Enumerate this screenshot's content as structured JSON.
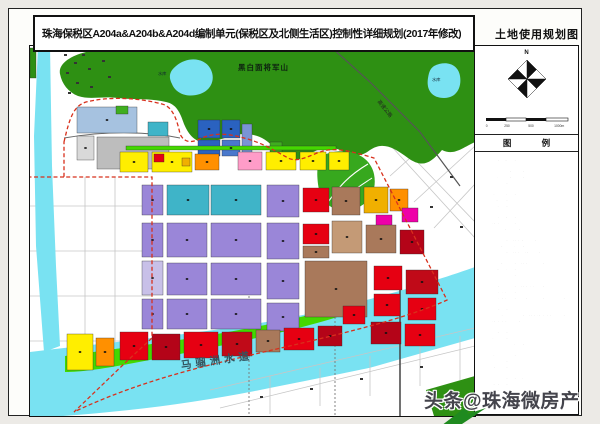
{
  "page_title": "珠海保税区A204a&A204b&A204d编制单元(保税区及北侧生活区)控制性详细规划(2017年修改)",
  "map_sheet_title": "土地使用规划图",
  "compass_label": "N",
  "scale_labels": [
    "0",
    "250",
    "500",
    "1000m"
  ],
  "legend_header": "图 例",
  "watermark": "头条@珠海微房产",
  "map_labels": {
    "mountain": "黑白面将军山",
    "reservoir_1": "水库",
    "reservoir_2": "水库",
    "expressway": "高速公路",
    "waterway": "马骝洲水道"
  },
  "colors": {
    "hill_green": "#2e9013",
    "park_green": "#37a81e",
    "water_cyan": "#79e2f2",
    "shore_green": "#44d800",
    "boundary_red": "#d8301c",
    "outside_road_gray": "#c6c6c6",
    "corner_green": "#1f8a1f"
  },
  "legend_items": [
    {
      "label": "二类居住用地",
      "color": "#ffee00"
    },
    {
      "label": "居住用地（兼容商业服务业设施用地）",
      "color": "#e0c000"
    },
    {
      "label": "一般商业中心用地",
      "color": "#ff5a28"
    },
    {
      "label": "二级商业中心用地",
      "color": "#c00a18"
    },
    {
      "label": "商业用地",
      "color": "#ff9000"
    },
    {
      "label": "行政办公用地",
      "color": "#ee00a8"
    },
    {
      "label": "文化设施用地",
      "color": "#ff9cc8"
    },
    {
      "label": "幼托用地",
      "color": "#ffb888"
    },
    {
      "label": "小学用地",
      "color": "#ff8428"
    },
    {
      "label": "中学用地",
      "color": "#ff3c14"
    },
    {
      "label": "医疗卫生用地",
      "color": "#ffc8d2"
    },
    {
      "label": "社会福利用地",
      "color": "#b05ad0"
    },
    {
      "label": "加油加气站用地",
      "color": "#ee0040"
    },
    {
      "label": "商业用地（兼容二类居住用地）",
      "color": "#c81428"
    },
    {
      "label": "商业用地（兼容办公用地）",
      "color": "#aa0a20"
    },
    {
      "label": "商业办公混合用地",
      "color": "#8e0414"
    },
    {
      "label": "商业用地（兼容旅馆业用地）",
      "color": "#b04a34"
    },
    {
      "label": "商务办公用地",
      "color": "#7c0a0a"
    },
    {
      "label": "商务办公用地（兼容商业用地）",
      "color": "#a85a48"
    },
    {
      "label": "商住混合用地",
      "color": "#960000"
    },
    {
      "label": "新型产业用地",
      "color": "#e8b49c"
    },
    {
      "label": "一类工业用地",
      "color": "#a06848"
    },
    {
      "label": "一类工业用地（兼容仓储用地）",
      "color": "#c49a76"
    },
    {
      "label": "物流仓储用地",
      "color": "#b2a2ba"
    },
    {
      "label": "混合功能用地（一类工业用地＋商业用地）",
      "color": "#e60028"
    },
    {
      "label": "弹性管理用地（一类工业用地＋新型产业用地＋仓储用地）",
      "color": "#b8a8e0"
    },
    {
      "label": "特殊用地",
      "color": "#8294b2"
    },
    {
      "label": "公共交通场站用地（兼容社会停车场用地）",
      "color": "#8a6cc8"
    },
    {
      "label": "社会停车场用地",
      "color": "#ccc2ea"
    },
    {
      "label": "供水用地",
      "color": "#2a5ac0"
    },
    {
      "label": "供电用地",
      "color": "#4a82d8"
    },
    {
      "label": "排水用地",
      "color": "#0a86a0"
    },
    {
      "label": "其他公用设施用地",
      "color": "#1aa89e"
    },
    {
      "label": "口岸设施用地",
      "color": "#32b6d0"
    },
    {
      "label": "交通枢纽用地",
      "color": "#8ecce8"
    },
    {
      "label": "公园绿地",
      "color": "#22a822"
    },
    {
      "label": "防护绿地",
      "color": "#7ed23e"
    },
    {
      "label": "广场用地",
      "color": "#2ec662"
    },
    {
      "label": "公园绿地（地下空间利用）",
      "color": "#a8e078"
    },
    {
      "label": "生态绿地",
      "color": "#d2eeb0"
    },
    {
      "label": "湿地",
      "color": "#aef0e6"
    },
    {
      "label": "水域",
      "color": "#9ae8f8"
    },
    {
      "label": "道路用地",
      "color": "#ffffff"
    }
  ],
  "parcels": [
    {
      "x": 47,
      "y": 61,
      "w": 60,
      "h": 26,
      "c": "#a6c2e0"
    },
    {
      "x": 67,
      "y": 91,
      "w": 72,
      "h": 32,
      "c": "#bdbdbd"
    },
    {
      "x": 47,
      "y": 90,
      "w": 17,
      "h": 24,
      "c": "#d9d9d9"
    },
    {
      "x": 168,
      "y": 74,
      "w": 22,
      "h": 18,
      "c": "#2a62c0"
    },
    {
      "x": 192,
      "y": 74,
      "w": 18,
      "h": 18,
      "c": "#2a62c0"
    },
    {
      "x": 168,
      "y": 94,
      "w": 22,
      "h": 16,
      "c": "#2a62c0"
    },
    {
      "x": 192,
      "y": 94,
      "w": 18,
      "h": 16,
      "c": "#4a78cc"
    },
    {
      "x": 212,
      "y": 78,
      "w": 10,
      "h": 30,
      "c": "#7a94d4"
    },
    {
      "x": 118,
      "y": 76,
      "w": 20,
      "h": 14,
      "c": "#3fb4c8"
    },
    {
      "x": 240,
      "y": 96,
      "w": 12,
      "h": 10,
      "c": "#3fae1f"
    },
    {
      "x": 96,
      "y": 100,
      "w": 210,
      "h": 4,
      "c": "#44d800"
    },
    {
      "x": 86,
      "y": 60,
      "w": 12,
      "h": 8,
      "c": "#3fae1f"
    },
    {
      "x": 0,
      "y": 2,
      "w": 6,
      "h": 30,
      "c": "#2e9013"
    },
    {
      "x": 90,
      "y": 106,
      "w": 28,
      "h": 20,
      "c": "#ffee00"
    },
    {
      "x": 122,
      "y": 106,
      "w": 40,
      "h": 20,
      "c": "#ffee00"
    },
    {
      "x": 165,
      "y": 108,
      "w": 24,
      "h": 16,
      "c": "#ff9000"
    },
    {
      "x": 208,
      "y": 106,
      "w": 24,
      "h": 18,
      "c": "#ff9cc8"
    },
    {
      "x": 236,
      "y": 106,
      "w": 30,
      "h": 18,
      "c": "#ffee00"
    },
    {
      "x": 270,
      "y": 106,
      "w": 26,
      "h": 18,
      "c": "#ffee00"
    },
    {
      "x": 299,
      "y": 106,
      "w": 20,
      "h": 18,
      "c": "#ffee00"
    },
    {
      "x": 124,
      "y": 108,
      "w": 10,
      "h": 8,
      "c": "#e60012"
    },
    {
      "x": 152,
      "y": 112,
      "w": 8,
      "h": 8,
      "c": "#f0b000"
    },
    {
      "x": 137,
      "y": 139,
      "w": 42,
      "h": 30,
      "c": "#3fb4c8"
    },
    {
      "x": 181,
      "y": 139,
      "w": 50,
      "h": 30,
      "c": "#3fb4c8"
    },
    {
      "x": 237,
      "y": 139,
      "w": 32,
      "h": 32,
      "c": "#9a86d8"
    },
    {
      "x": 273,
      "y": 142,
      "w": 26,
      "h": 24,
      "c": "#e60012"
    },
    {
      "x": 302,
      "y": 141,
      "w": 28,
      "h": 28,
      "c": "#a9795b"
    },
    {
      "x": 334,
      "y": 141,
      "w": 24,
      "h": 26,
      "c": "#f0b000"
    },
    {
      "x": 360,
      "y": 143,
      "w": 18,
      "h": 22,
      "c": "#ff9000"
    },
    {
      "x": 346,
      "y": 169,
      "w": 16,
      "h": 12,
      "c": "#ee00a8"
    },
    {
      "x": 112,
      "y": 139,
      "w": 21,
      "h": 30,
      "c": "#9a86d8"
    },
    {
      "x": 112,
      "y": 177,
      "w": 21,
      "h": 34,
      "c": "#9a86d8"
    },
    {
      "x": 112,
      "y": 215,
      "w": 21,
      "h": 34,
      "c": "#c8c0e8"
    },
    {
      "x": 112,
      "y": 253,
      "w": 21,
      "h": 30,
      "c": "#9a86d8"
    },
    {
      "x": 137,
      "y": 177,
      "w": 40,
      "h": 34,
      "c": "#9a86d8"
    },
    {
      "x": 181,
      "y": 177,
      "w": 50,
      "h": 34,
      "c": "#9a86d8"
    },
    {
      "x": 237,
      "y": 177,
      "w": 32,
      "h": 36,
      "c": "#9a86d8"
    },
    {
      "x": 273,
      "y": 178,
      "w": 26,
      "h": 20,
      "c": "#e60012"
    },
    {
      "x": 273,
      "y": 200,
      "w": 26,
      "h": 12,
      "c": "#a9795b"
    },
    {
      "x": 302,
      "y": 175,
      "w": 30,
      "h": 32,
      "c": "#c49a76"
    },
    {
      "x": 336,
      "y": 179,
      "w": 30,
      "h": 28,
      "c": "#a9795b"
    },
    {
      "x": 370,
      "y": 184,
      "w": 24,
      "h": 24,
      "c": "#b40418"
    },
    {
      "x": 137,
      "y": 217,
      "w": 40,
      "h": 32,
      "c": "#9a86d8"
    },
    {
      "x": 181,
      "y": 217,
      "w": 50,
      "h": 32,
      "c": "#9a86d8"
    },
    {
      "x": 237,
      "y": 217,
      "w": 32,
      "h": 36,
      "c": "#9a86d8"
    },
    {
      "x": 275,
      "y": 215,
      "w": 62,
      "h": 56,
      "c": "#a9795b"
    },
    {
      "x": 344,
      "y": 220,
      "w": 28,
      "h": 24,
      "c": "#e60012"
    },
    {
      "x": 376,
      "y": 224,
      "w": 32,
      "h": 24,
      "c": "#c00a18"
    },
    {
      "x": 344,
      "y": 248,
      "w": 26,
      "h": 22,
      "c": "#e60012"
    },
    {
      "x": 378,
      "y": 252,
      "w": 28,
      "h": 22,
      "c": "#e60012"
    },
    {
      "x": 372,
      "y": 162,
      "w": 16,
      "h": 14,
      "c": "#ee00a8"
    },
    {
      "x": 137,
      "y": 253,
      "w": 40,
      "h": 30,
      "c": "#9a86d8"
    },
    {
      "x": 181,
      "y": 253,
      "w": 50,
      "h": 30,
      "c": "#9a86d8"
    },
    {
      "x": 237,
      "y": 257,
      "w": 32,
      "h": 28,
      "c": "#9a86d8"
    },
    {
      "x": 341,
      "y": 276,
      "w": 30,
      "h": 22,
      "c": "#b40418"
    },
    {
      "x": 375,
      "y": 278,
      "w": 30,
      "h": 22,
      "c": "#e60012"
    },
    {
      "x": 37,
      "y": 288,
      "w": 26,
      "h": 36,
      "c": "#ffee00"
    },
    {
      "x": 66,
      "y": 292,
      "w": 18,
      "h": 28,
      "c": "#ff9000"
    },
    {
      "x": 90,
      "y": 286,
      "w": 28,
      "h": 28,
      "c": "#e60012"
    },
    {
      "x": 122,
      "y": 288,
      "w": 28,
      "h": 26,
      "c": "#b40418"
    },
    {
      "x": 154,
      "y": 286,
      "w": 34,
      "h": 26,
      "c": "#e60012"
    },
    {
      "x": 192,
      "y": 286,
      "w": 30,
      "h": 24,
      "c": "#c00a18"
    },
    {
      "x": 226,
      "y": 284,
      "w": 24,
      "h": 22,
      "c": "#a9795b"
    },
    {
      "x": 254,
      "y": 282,
      "w": 30,
      "h": 22,
      "c": "#e60012"
    },
    {
      "x": 288,
      "y": 280,
      "w": 24,
      "h": 20,
      "c": "#b40418"
    },
    {
      "x": 313,
      "y": 260,
      "w": 22,
      "h": 18,
      "c": "#e60012"
    }
  ],
  "marks": [
    {
      "x": 34,
      "y": 8
    },
    {
      "x": 44,
      "y": 16
    },
    {
      "x": 36,
      "y": 26
    },
    {
      "x": 46,
      "y": 36
    },
    {
      "x": 38,
      "y": 46
    },
    {
      "x": 52,
      "y": 8
    },
    {
      "x": 58,
      "y": 22
    },
    {
      "x": 60,
      "y": 40
    },
    {
      "x": 72,
      "y": 14
    },
    {
      "x": 78,
      "y": 30
    },
    {
      "x": 420,
      "y": 130
    },
    {
      "x": 400,
      "y": 160
    },
    {
      "x": 430,
      "y": 180
    },
    {
      "x": 230,
      "y": 350
    },
    {
      "x": 280,
      "y": 342
    },
    {
      "x": 330,
      "y": 332
    },
    {
      "x": 390,
      "y": 320
    }
  ]
}
